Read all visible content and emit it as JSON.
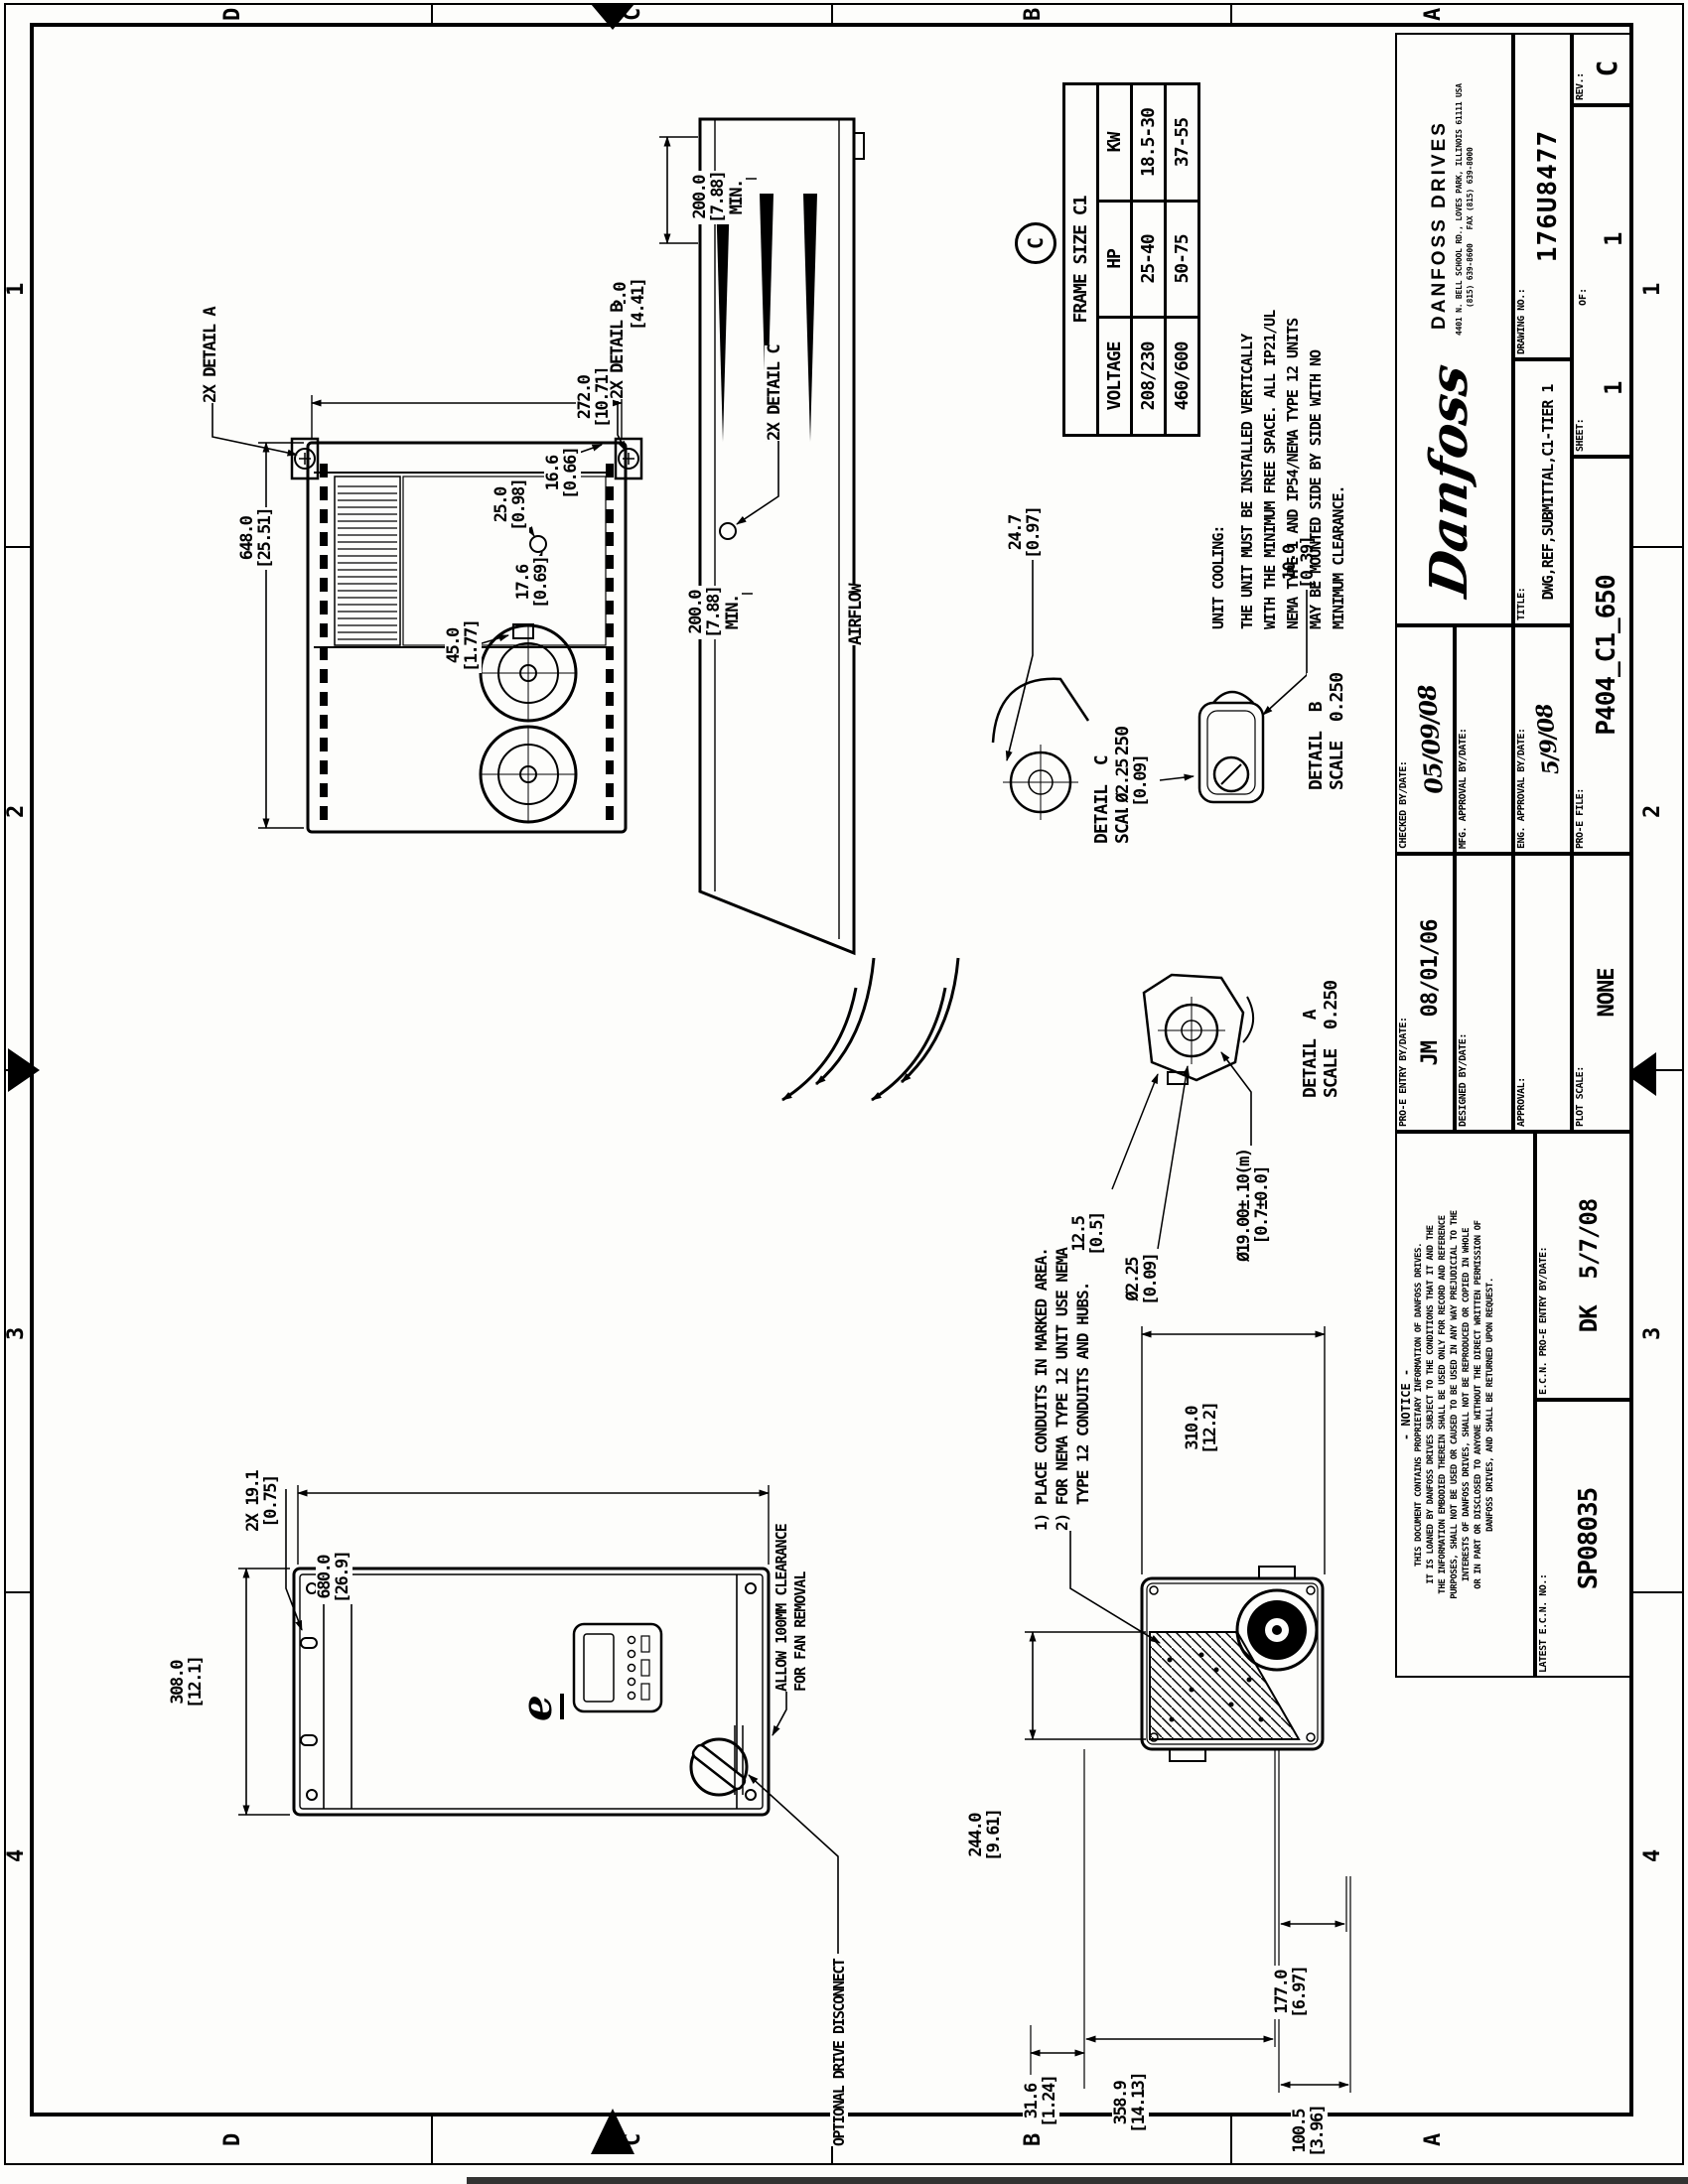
{
  "zones": {
    "cols": [
      "4",
      "3",
      "2",
      "1"
    ],
    "rows": [
      "D",
      "C",
      "B",
      "A"
    ]
  },
  "views": {
    "front": {
      "logo_glyph": "e",
      "clearance_note": [
        "ALLOW 100MM CLEARANCE",
        "FOR FAN REMOVAL"
      ],
      "disconnect_label": "OPTIONAL DRIVE DISCONNECT"
    },
    "side": {
      "airflow_label": "AIRFLOW"
    },
    "callouts": {
      "a": "2X DETAIL A",
      "b": "2X DETAIL B",
      "c": "2X DETAIL C"
    },
    "details": {
      "a": {
        "name": "DETAIL  A",
        "scale": "SCALE  0.250"
      },
      "b": {
        "name": "DETAIL  B",
        "scale": "SCALE  0.250"
      },
      "c": {
        "name": "DETAIL  C",
        "scale": "SCALE  0.250"
      }
    }
  },
  "dims": {
    "d648": {
      "mm": "648.0",
      "in": "[25.51]"
    },
    "d272": {
      "mm": "272.0",
      "in": "[10.71]"
    },
    "d166": {
      "mm": "16.6",
      "in": "[0.66]"
    },
    "d176": {
      "mm": "17.6",
      "in": "[0.69]"
    },
    "d250": {
      "mm": "25.0",
      "in": "[0.98]"
    },
    "d450": {
      "mm": "45.0",
      "in": "[1.77]"
    },
    "d247": {
      "mm": "24.7",
      "in": "[0.97]"
    },
    "d100": {
      "mm": "10.0",
      "in": "[0.39]"
    },
    "d225": {
      "mm": "Ø2.25",
      "in": "[0.09]"
    },
    "d125": {
      "mm": "12.5",
      "in": "[0.5]"
    },
    "d1900": {
      "mm": "Ø19.00±.10(m)",
      "in": "[0.7±0.0]"
    },
    "d112": {
      "mm": "112.0",
      "in": "[4.41]"
    },
    "d200": {
      "mm": "200.0",
      "in": "[7.88]",
      "extra": "MIN."
    },
    "d308": {
      "mm": "308.0",
      "in": "[12.1]"
    },
    "d191": {
      "mm": "2X 19.1",
      "in": "[0.75]"
    },
    "d680": {
      "mm": "680.0",
      "in": "[26.9]"
    },
    "d310": {
      "mm": "310.0",
      "in": "[12.2]"
    },
    "d244": {
      "mm": "244.0",
      "in": "[9.61]"
    },
    "d316": {
      "mm": "31.6",
      "in": "[1.24]"
    },
    "d177": {
      "mm": "177.0",
      "in": "[6.97]"
    },
    "d1005": {
      "mm": "100.5",
      "in": "[3.96]"
    },
    "d3589": {
      "mm": "358.9",
      "in": "[14.13]"
    }
  },
  "conduit_note": {
    "lines": [
      "1) PLACE CONDUITS IN MARKED AREA.",
      "2) FOR NEMA TYPE 12 UNIT USE NEMA",
      "   TYPE 12 CONDUITS AND HUBS."
    ]
  },
  "unit_cooling": {
    "heading": "UNIT COOLING:",
    "lines": [
      "THE UNIT MUST BE INSTALLED VERTICALLY",
      "WITH THE MINIMUM FREE SPACE. ALL IP21/UL",
      "NEMA TYPE 1 AND IP54/NEMA TYPE 12 UNITS",
      "MAY BE MOUNTED SIDE BY SIDE WITH NO",
      "MINIMUM CLEARANCE."
    ]
  },
  "frame_table": {
    "title": "FRAME SIZE C1",
    "marker": "C",
    "columns": [
      "VOLTAGE",
      "HP",
      "KW"
    ],
    "rows": [
      [
        "208/230",
        "25-40",
        "18.5-30"
      ],
      [
        "460/600",
        "50-75",
        "37-55"
      ]
    ]
  },
  "title_block": {
    "notice": {
      "title": "- NOTICE -",
      "lines": [
        "THIS DOCUMENT CONTAINS PROPRIETARY INFORMATION OF DANFOSS DRIVES.",
        "IT IS LOANED BY DANFOSS DRIVES SUBJECT TO THE CONDITIONS THAT IT AND THE",
        "THE INFORMATION EMBODIED THEREIN SHALL BE USED ONLY FOR RECORD AND REFERENCE",
        "PURPOSES, SHALL NOT BE USED OR CAUSED TO BE USED IN ANY WAY PREJUDICIAL TO THE",
        "INTERESTS OF DANFOSS DRIVES, SHALL NOT BE REPRODUCED OR COPIED IN WHOLE",
        "OR IN PART OR DISCLOSED TO ANYONE WITHOUT THE DIRECT WRITTEN PERMISSION OF",
        "DANFOSS DRIVES, AND SHALL BE RETURNED UPON REQUEST."
      ]
    },
    "latest_ecn": {
      "label": "LATEST E.C.N. NO.:",
      "value": "SP08035"
    },
    "ecn_entry": {
      "label": "E.C.N. PRO-E ENTRY BY/DATE:",
      "value": "DK  5/7/08"
    },
    "proe_entry": {
      "label": "PRO-E ENTRY BY/DATE:",
      "value": "JM  08/01/06"
    },
    "designed": {
      "label": "DESIGNED BY/DATE:"
    },
    "approval": {
      "label": "APPROVAL:"
    },
    "plot_scale": {
      "label": "PLOT SCALE:",
      "value": "NONE"
    },
    "checked": {
      "label": "CHECKED BY/DATE:",
      "value": "05/09/08"
    },
    "mfg_approval": {
      "label": "MFG. APPROVAL BY/DATE:"
    },
    "eng_approval": {
      "label": "ENG. APPROVAL BY/DATE:",
      "value": "5/9/08"
    },
    "proe_file": {
      "label": "PRO-E FILE:",
      "value": "P404_C1_650"
    },
    "company": {
      "script": "Danfoss",
      "name": "DANFOSS DRIVES",
      "address_line1": "4401 N. BELL SCHOOL RD., LOVES PARK, ILLINOIS 61111 USA",
      "address_line2": "(815) 639-8600   FAX (815) 639-8000"
    },
    "title": {
      "label": "TITLE:",
      "value": "DWG,REF,SUBMITTAL,C1-TIER 1"
    },
    "drawing_no": {
      "label": "DRAWING NO.:",
      "value": "176U8477"
    },
    "sheet_no": {
      "label": "SHEET:",
      "value": "1",
      "of_label": "OF:",
      "of_value": "1"
    },
    "rev": {
      "label": "REV.:",
      "value": "C"
    }
  }
}
